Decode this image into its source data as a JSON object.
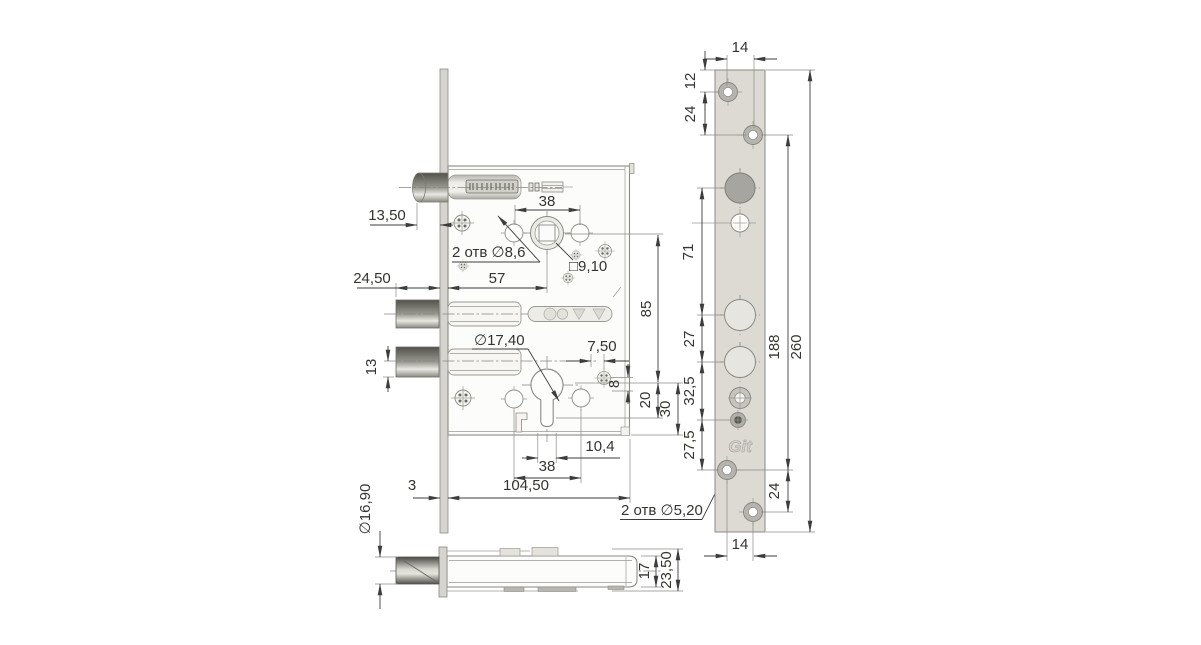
{
  "drawing_type": "mortise-lock technical drawing",
  "colors": {
    "background": "#ffffff",
    "dimension_line": "#3d3d3d",
    "part_outline": "#8c8a84",
    "faceplate_fill": "#dcdad3",
    "metal_dark": "#52514b",
    "metal_light": "#e9e8e2"
  },
  "front_view": {
    "dims": {
      "latch_protrusion": "13,50",
      "upper_holes_spacing": "38",
      "upper_holes_note": "2 отв ∅8,6",
      "follower_square": "□9,10",
      "deadbolt_throw": "24,50",
      "backset": "57",
      "follower_to_cylinder": "85",
      "cylinder_hole_dia": "∅17,40",
      "screw_offset": "7,50",
      "deadbolt_center": "13",
      "screw_drop": "8",
      "keyway_depth": "20",
      "cylinder_to_bottom": "30",
      "keyway_width": "10,4",
      "lower_holes_spacing": "38",
      "body_length": "104,50",
      "faceplate_thickness": "3",
      "faceplate_holes_note": "2 отв ∅5,20"
    }
  },
  "bottom_view": {
    "dims": {
      "deadbolt_dia": "∅16,90",
      "case_thickness": "17",
      "overall_thickness": "23,50"
    }
  },
  "faceplate_view": {
    "logo": "Git",
    "dims": {
      "holes_x_offset_top": "14",
      "edge_to_first_hole": "12",
      "top_pair_spacing": "24",
      "latch_to_spindle": "71",
      "spindle_pair_spacing": "27",
      "lower_gap": "32,5",
      "bottom_gap": "27,5",
      "mounting_span": "188",
      "plate_length": "260",
      "bottom_pair_spacing": "24",
      "holes_x_offset_bottom": "14"
    }
  }
}
